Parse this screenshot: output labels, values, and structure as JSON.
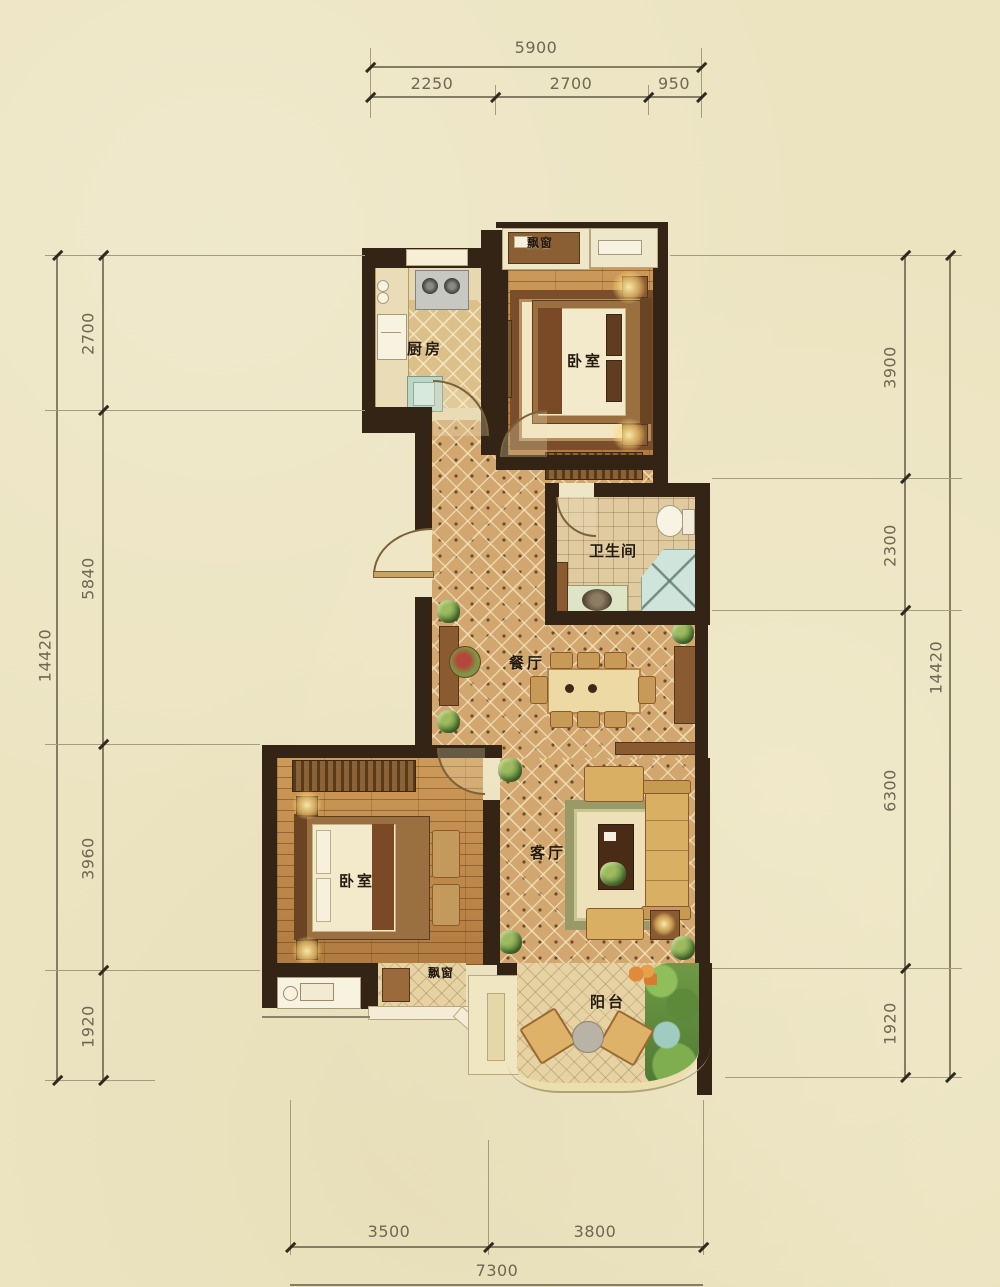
{
  "dims": {
    "top": {
      "total": "5900",
      "segments": [
        "2250",
        "2700",
        "950"
      ]
    },
    "left": {
      "total": "14420",
      "segments": [
        "2700",
        "5840",
        "3960",
        "1920"
      ]
    },
    "right": {
      "total": "14420",
      "segments": [
        "3900",
        "2300",
        "6300",
        "1920"
      ]
    },
    "bottom": {
      "total": "7300",
      "segments": [
        "3500",
        "3800"
      ]
    }
  },
  "rooms": {
    "kitchen": "厨房",
    "bedroom_top": "卧室",
    "bathroom": "卫生间",
    "dining": "餐厅",
    "living": "客厅",
    "bedroom_bottom": "卧室",
    "balcony": "阳台",
    "bay_top": "飘窗",
    "bay_bottom": "飘窗"
  }
}
